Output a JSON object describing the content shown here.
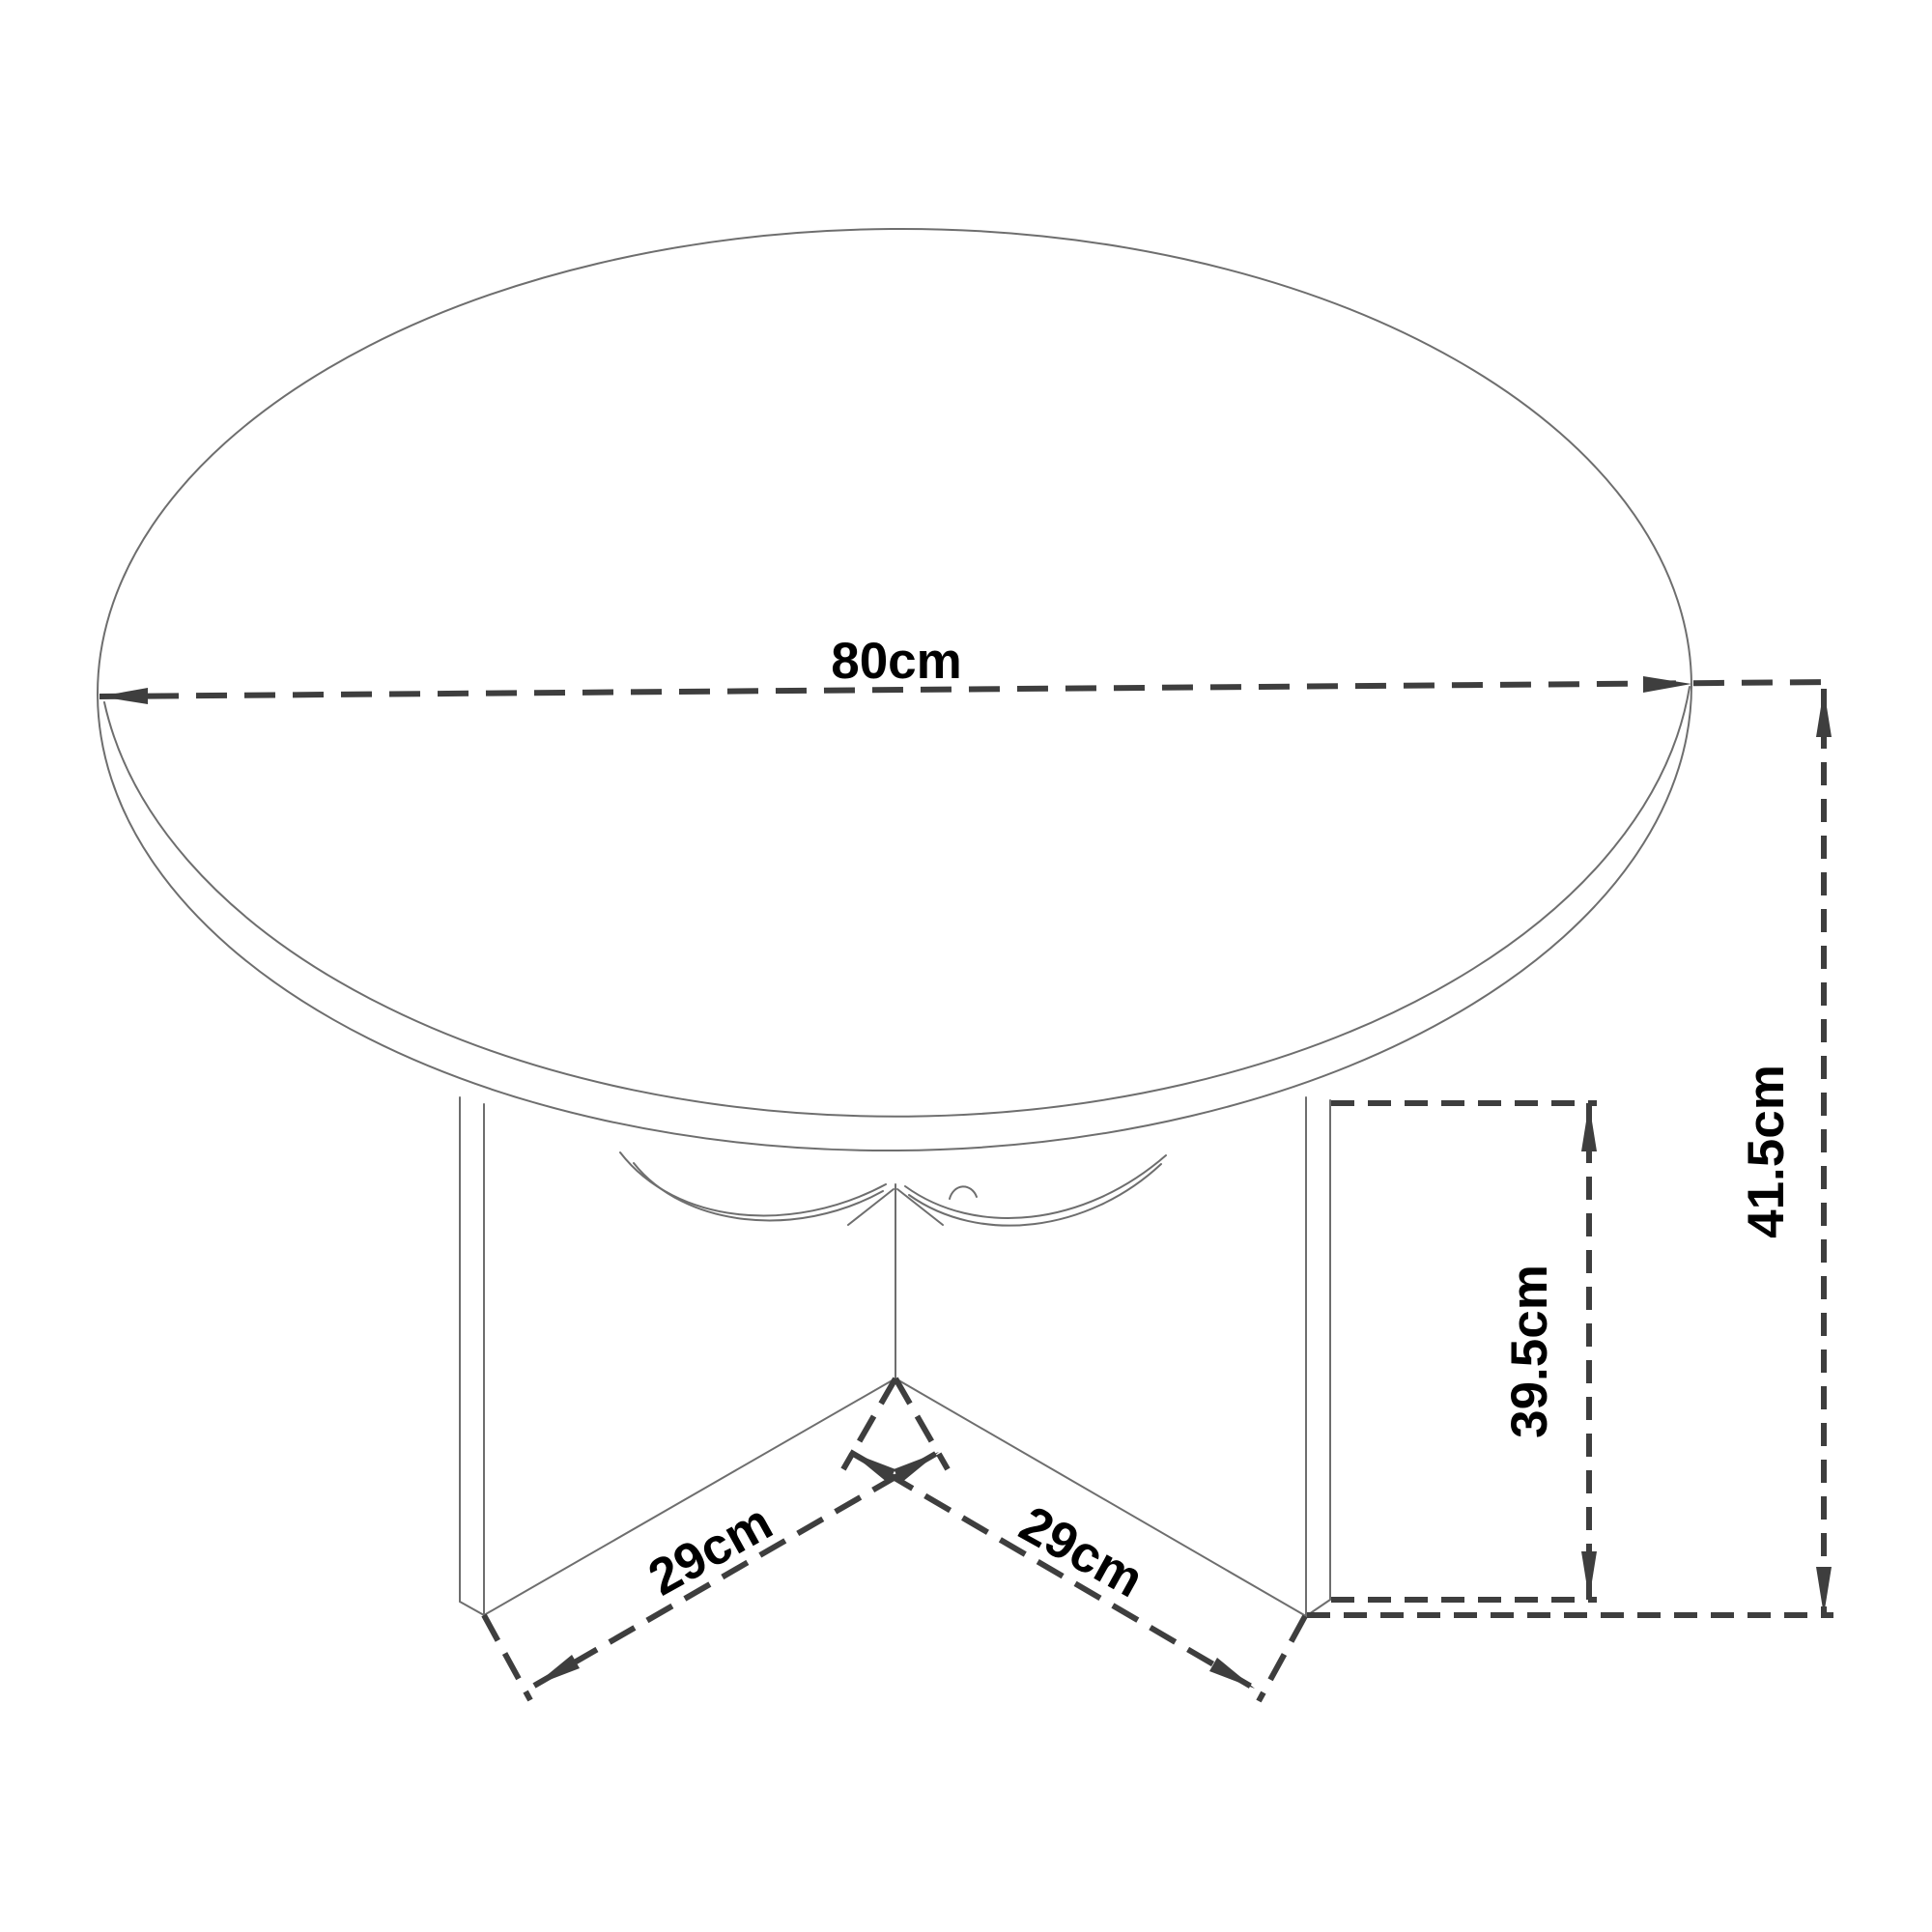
{
  "figure": {
    "type": "technical-dimension-drawing",
    "subject": "round table with x-cross legs",
    "units": "cm"
  },
  "dimensions": {
    "diameter": {
      "label": "80cm",
      "value": 80,
      "orientation": "horizontal"
    },
    "total_height": {
      "label": "41.5cm",
      "value": 41.5,
      "orientation": "vertical"
    },
    "leg_height": {
      "label": "39.5cm",
      "value": 39.5,
      "orientation": "vertical"
    },
    "leg_left": {
      "label": "29cm",
      "value": 29,
      "orientation": "diagonal"
    },
    "leg_right": {
      "label": "29cm",
      "value": 29,
      "orientation": "diagonal"
    }
  },
  "colors": {
    "background": "#ffffff",
    "outline": "#6e6e6e",
    "dimension_lines": "#3e3e3e",
    "label_text": "#000000"
  }
}
